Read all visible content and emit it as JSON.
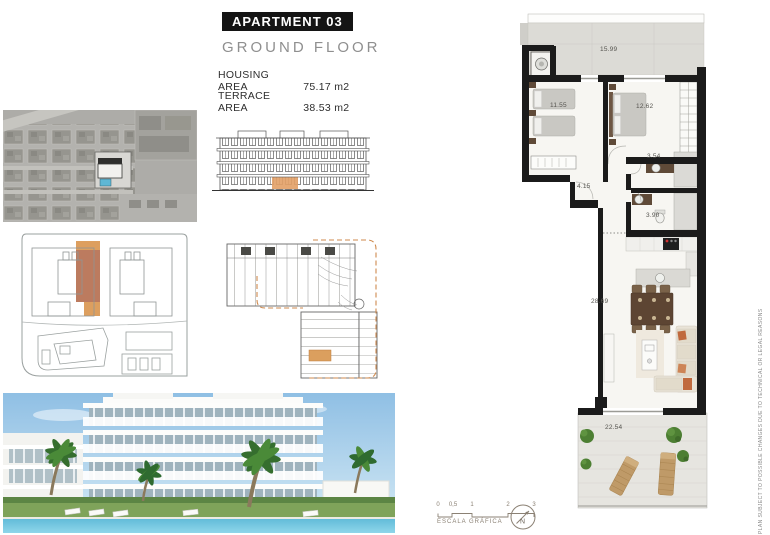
{
  "header": {
    "apartment_label": "APARTMENT 03",
    "floor_label": "GROUND FLOOR",
    "housing_area_label": "HOUSING AREA",
    "housing_area_value": "75.17 m2",
    "terrace_area_label": "TERRACE AREA",
    "terrace_area_value": "38.53 m2"
  },
  "floor_plan": {
    "rooms": {
      "terrace_top": "15.99",
      "bedroom_1": "11.55",
      "bedroom_2": "12.62",
      "bathroom_1": "3.54",
      "hall": "4.15",
      "bathroom_2": "3.90",
      "living_kitchen": "28.69",
      "terrace_bottom": "22.54"
    }
  },
  "scale_bar": {
    "ticks": [
      "0",
      "0,5",
      "1",
      "2",
      "3"
    ],
    "label": "ESCALA GRÁFICA"
  },
  "compass": {
    "letter": "N"
  },
  "disclaimer": "PLAN SUBJECT TO POSSIBLE CHANGES DUE TO TECHNICAL OR LEGAL REASONS",
  "colors": {
    "wall_black": "#1b1b1b",
    "highlight_orange": "#dd9f5f",
    "highlight_terracotta": "#bc7b5f",
    "pool_blue": "#5fb7d4",
    "title_bg": "#141414"
  }
}
